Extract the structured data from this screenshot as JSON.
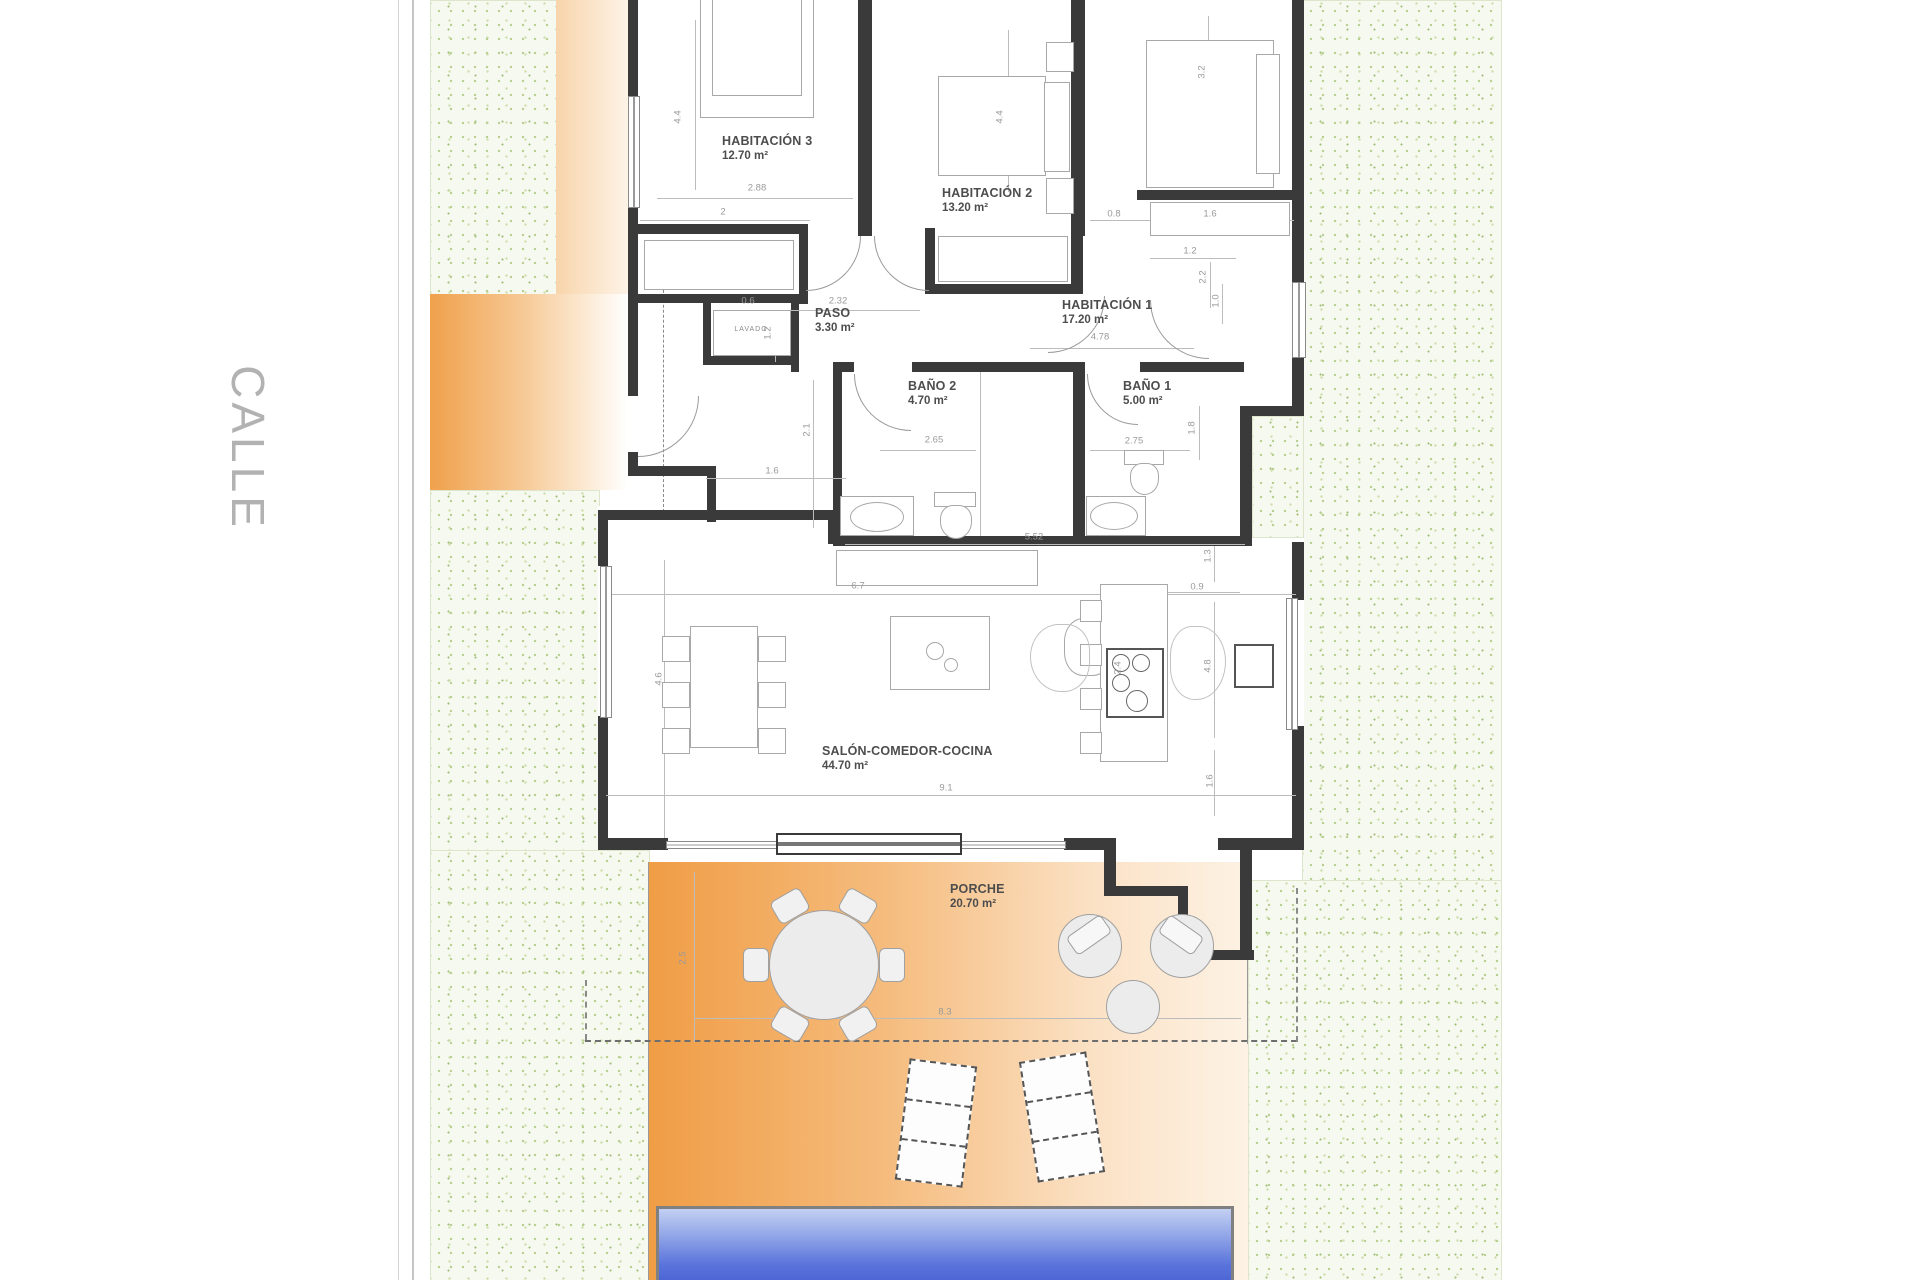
{
  "street_label": "CALLE",
  "closet_label": "LAVADO",
  "rooms": [
    {
      "id": "habitacion3",
      "name": "HABITACIÓN 3",
      "area": "12.70 m²",
      "x": 722,
      "y": 134
    },
    {
      "id": "habitacion2",
      "name": "HABITACIÓN 2",
      "area": "13.20 m²",
      "x": 942,
      "y": 186
    },
    {
      "id": "habitacion1",
      "name": "HABITACIÓN 1",
      "area": "17.20 m²",
      "x": 1062,
      "y": 298
    },
    {
      "id": "paso",
      "name": "PASO",
      "area": "3.30 m²",
      "x": 815,
      "y": 306
    },
    {
      "id": "bano2",
      "name": "BAÑO 2",
      "area": "4.70 m²",
      "x": 908,
      "y": 379
    },
    {
      "id": "bano1",
      "name": "BAÑO 1",
      "area": "5.00 m²",
      "x": 1123,
      "y": 379
    },
    {
      "id": "salon",
      "name": "SALÓN-COMEDOR-COCINA",
      "area": "44.70 m²",
      "x": 822,
      "y": 744
    },
    {
      "id": "porche",
      "name": "PORCHE",
      "area": "20.70 m²",
      "x": 950,
      "y": 882
    }
  ],
  "dimensions": [
    {
      "v": "4.4",
      "x": 678,
      "y": 117,
      "o": "v"
    },
    {
      "v": "2.88",
      "x": 757,
      "y": 188,
      "o": "h"
    },
    {
      "v": "2",
      "x": 723,
      "y": 212,
      "o": "h"
    },
    {
      "v": "4.4",
      "x": 1000,
      "y": 117,
      "o": "v"
    },
    {
      "v": "3.2",
      "x": 1202,
      "y": 72,
      "o": "v"
    },
    {
      "v": "0.8",
      "x": 1114,
      "y": 214,
      "o": "h"
    },
    {
      "v": "1.6",
      "x": 1210,
      "y": 214,
      "o": "h"
    },
    {
      "v": "1.2",
      "x": 1190,
      "y": 251,
      "o": "h"
    },
    {
      "v": "2.2",
      "x": 1203,
      "y": 277,
      "o": "v"
    },
    {
      "v": "1.0",
      "x": 1216,
      "y": 301,
      "o": "v"
    },
    {
      "v": "2.32",
      "x": 838,
      "y": 301,
      "o": "h"
    },
    {
      "v": "0.6",
      "x": 748,
      "y": 301,
      "o": "h"
    },
    {
      "v": "1.2",
      "x": 768,
      "y": 333,
      "o": "v"
    },
    {
      "v": "4.78",
      "x": 1100,
      "y": 337,
      "o": "h"
    },
    {
      "v": "2.1",
      "x": 807,
      "y": 430,
      "o": "v"
    },
    {
      "v": "1.6",
      "x": 772,
      "y": 471,
      "o": "h"
    },
    {
      "v": "2.65",
      "x": 934,
      "y": 440,
      "o": "h"
    },
    {
      "v": "2.75",
      "x": 1134,
      "y": 441,
      "o": "h"
    },
    {
      "v": "1.8",
      "x": 1192,
      "y": 428,
      "o": "v"
    },
    {
      "v": "5.52",
      "x": 1034,
      "y": 537,
      "o": "h"
    },
    {
      "v": "6.7",
      "x": 858,
      "y": 586,
      "o": "h"
    },
    {
      "v": "4.6",
      "x": 659,
      "y": 679,
      "o": "v"
    },
    {
      "v": "9.1",
      "x": 946,
      "y": 788,
      "o": "h"
    },
    {
      "v": "2.4",
      "x": 1118,
      "y": 668,
      "o": "v"
    },
    {
      "v": "0.9",
      "x": 1197,
      "y": 587,
      "o": "h"
    },
    {
      "v": "4.8",
      "x": 1208,
      "y": 666,
      "o": "v"
    },
    {
      "v": "1.3",
      "x": 1208,
      "y": 556,
      "o": "v"
    },
    {
      "v": "1.6",
      "x": 1210,
      "y": 781,
      "o": "v"
    },
    {
      "v": "2.5",
      "x": 683,
      "y": 958,
      "o": "v"
    },
    {
      "v": "8.3",
      "x": 945,
      "y": 1012,
      "o": "h"
    }
  ],
  "colors": {
    "wall": "#3a3a3a",
    "grass_dot": "#b6ce8e",
    "terrace_orange": "#f09d45",
    "pool_top": "#c3d0f2",
    "pool_bottom": "#4a63d2",
    "dim_text": "#9a9a9a",
    "label_text": "#4d4d4d",
    "street_text": "#b2b2b2"
  }
}
